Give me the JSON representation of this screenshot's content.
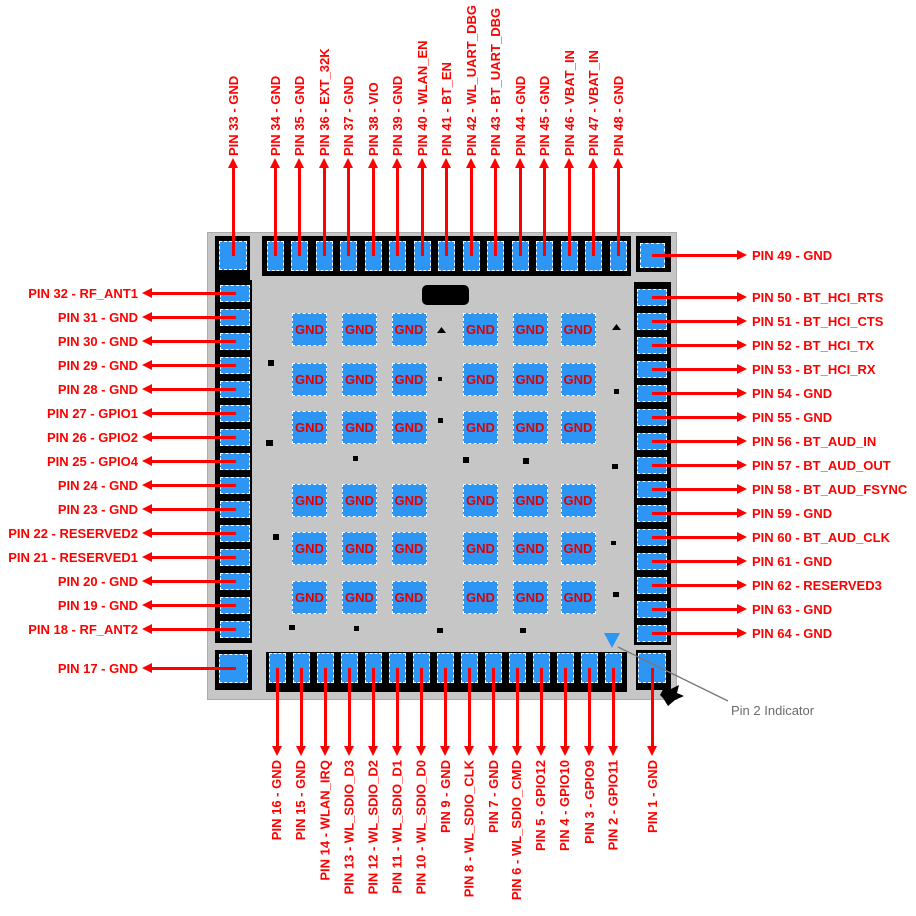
{
  "chip": {
    "description": "64-pin QFN package pinout diagram",
    "pin2_indicator_label": "Pin 2 Indicator",
    "gnd_grid": {
      "rows": 6,
      "cols": 6,
      "pad_label": "GND"
    },
    "colors": {
      "pad_blue": "#2D96F5",
      "arrow_red": "#FF0000",
      "gnd_text_red": "#E00000",
      "chip_gray": "#C6C6C6",
      "band_black": "#000000",
      "callout_gray": "#6B6B6B"
    },
    "pins": {
      "top": [
        {
          "num": 33,
          "signal": "GND",
          "label": "PIN 33 - GND"
        },
        {
          "num": 34,
          "signal": "GND",
          "label": "PIN 34 - GND"
        },
        {
          "num": 35,
          "signal": "GND",
          "label": "PIN 35 - GND"
        },
        {
          "num": 36,
          "signal": "EXT_32K",
          "label": "PIN 36 - EXT_32K"
        },
        {
          "num": 37,
          "signal": "GND",
          "label": "PIN 37 - GND"
        },
        {
          "num": 38,
          "signal": "VIO",
          "label": "PIN 38 - VIO"
        },
        {
          "num": 39,
          "signal": "GND",
          "label": "PIN 39 - GND"
        },
        {
          "num": 40,
          "signal": "WLAN_EN",
          "label": "PIN 40 - WLAN_EN"
        },
        {
          "num": 41,
          "signal": "BT_EN",
          "label": "PIN 41 - BT_EN"
        },
        {
          "num": 42,
          "signal": "WL_UART_DBG",
          "label": "PIN 42 - WL_UART_DBG"
        },
        {
          "num": 43,
          "signal": "BT_UART_DBG",
          "label": "PIN 43 - BT_UART_DBG"
        },
        {
          "num": 44,
          "signal": "GND",
          "label": "PIN 44 - GND"
        },
        {
          "num": 45,
          "signal": "GND",
          "label": "PIN 45 - GND"
        },
        {
          "num": 46,
          "signal": "VBAT_IN",
          "label": "PIN 46 - VBAT_IN"
        },
        {
          "num": 47,
          "signal": "VBAT_IN",
          "label": "PIN 47 - VBAT_IN"
        },
        {
          "num": 48,
          "signal": "GND",
          "label": "PIN 48 - GND"
        }
      ],
      "right": [
        {
          "num": 49,
          "signal": "GND",
          "label": "PIN 49 - GND"
        },
        {
          "num": 50,
          "signal": "BT_HCI_RTS",
          "label": "PIN 50 - BT_HCI_RTS"
        },
        {
          "num": 51,
          "signal": "BT_HCI_CTS",
          "label": "PIN 51 - BT_HCI_CTS"
        },
        {
          "num": 52,
          "signal": "BT_HCI_TX",
          "label": "PIN 52 - BT_HCI_TX"
        },
        {
          "num": 53,
          "signal": "BT_HCI_RX",
          "label": "PIN 53 - BT_HCI_RX"
        },
        {
          "num": 54,
          "signal": "GND",
          "label": "PIN 54 - GND"
        },
        {
          "num": 55,
          "signal": "GND",
          "label": "PIN 55 - GND"
        },
        {
          "num": 56,
          "signal": "BT_AUD_IN",
          "label": "PIN 56 - BT_AUD_IN"
        },
        {
          "num": 57,
          "signal": "BT_AUD_OUT",
          "label": "PIN 57 - BT_AUD_OUT"
        },
        {
          "num": 58,
          "signal": "BT_AUD_FSYNC",
          "label": "PIN 58 - BT_AUD_FSYNC"
        },
        {
          "num": 59,
          "signal": "GND",
          "label": "PIN 59 - GND"
        },
        {
          "num": 60,
          "signal": "BT_AUD_CLK",
          "label": "PIN 60 - BT_AUD_CLK"
        },
        {
          "num": 61,
          "signal": "GND",
          "label": "PIN 61 - GND"
        },
        {
          "num": 62,
          "signal": "RESERVED3",
          "label": "PIN 62 - RESERVED3"
        },
        {
          "num": 63,
          "signal": "GND",
          "label": "PIN 63 - GND"
        },
        {
          "num": 64,
          "signal": "GND",
          "label": "PIN 64 - GND"
        }
      ],
      "left": [
        {
          "num": 32,
          "signal": "RF_ANT1",
          "label": "PIN 32 - RF_ANT1"
        },
        {
          "num": 31,
          "signal": "GND",
          "label": "PIN 31 - GND"
        },
        {
          "num": 30,
          "signal": "GND",
          "label": "PIN 30 - GND"
        },
        {
          "num": 29,
          "signal": "GND",
          "label": "PIN 29 - GND"
        },
        {
          "num": 28,
          "signal": "GND",
          "label": "PIN 28 - GND"
        },
        {
          "num": 27,
          "signal": "GPIO1",
          "label": "PIN 27 - GPIO1"
        },
        {
          "num": 26,
          "signal": "GPIO2",
          "label": "PIN 26 - GPIO2"
        },
        {
          "num": 25,
          "signal": "GPIO4",
          "label": "PIN 25 - GPIO4"
        },
        {
          "num": 24,
          "signal": "GND",
          "label": "PIN 24 - GND"
        },
        {
          "num": 23,
          "signal": "GND",
          "label": "PIN 23 - GND"
        },
        {
          "num": 22,
          "signal": "RESERVED2",
          "label": "PIN 22 - RESERVED2"
        },
        {
          "num": 21,
          "signal": "RESERVED1",
          "label": "PIN 21 - RESERVED1"
        },
        {
          "num": 20,
          "signal": "GND",
          "label": "PIN 20 - GND"
        },
        {
          "num": 19,
          "signal": "GND",
          "label": "PIN 19 - GND"
        },
        {
          "num": 18,
          "signal": "RF_ANT2",
          "label": "PIN 18 - RF_ANT2"
        },
        {
          "num": 17,
          "signal": "GND",
          "label": "PIN 17 - GND"
        }
      ],
      "bottom": [
        {
          "num": 16,
          "signal": "GND",
          "label": "PIN 16 - GND"
        },
        {
          "num": 15,
          "signal": "GND",
          "label": "PIN 15 - GND"
        },
        {
          "num": 14,
          "signal": "WLAN_IRQ",
          "label": "PIN 14 - WLAN_IRQ"
        },
        {
          "num": 13,
          "signal": "WL_SDIO_D3",
          "label": "PIN 13 - WL_SDIO_D3"
        },
        {
          "num": 12,
          "signal": "WL_SDIO_D2",
          "label": "PIN 12 - WL_SDIO_D2"
        },
        {
          "num": 11,
          "signal": "WL_SDIO_D1",
          "label": "PIN 11 - WL_SDIO_D1"
        },
        {
          "num": 10,
          "signal": "WL_SDIO_D0",
          "label": "PIN 10 - WL_SDIO_D0"
        },
        {
          "num": 9,
          "signal": "GND",
          "label": "PIN 9 - GND"
        },
        {
          "num": 8,
          "signal": "WL_SDIO_CLK",
          "label": "PIN 8 - WL_SDIO_CLK"
        },
        {
          "num": 7,
          "signal": "GND",
          "label": "PIN 7 - GND"
        },
        {
          "num": 6,
          "signal": "WL_SDIO_CMD",
          "label": "PIN 6 - WL_SDIO_CMD"
        },
        {
          "num": 5,
          "signal": "GPIO12",
          "label": "PIN 5 - GPIO12"
        },
        {
          "num": 4,
          "signal": "GPIO10",
          "label": "PIN 4 - GPIO10"
        },
        {
          "num": 3,
          "signal": "GPIO9",
          "label": "PIN 3 - GPIO9"
        },
        {
          "num": 2,
          "signal": "GPIO11",
          "label": "PIN 2 - GPIO11"
        },
        {
          "num": 1,
          "signal": "GND",
          "label": "PIN 1 - GND"
        }
      ]
    }
  }
}
